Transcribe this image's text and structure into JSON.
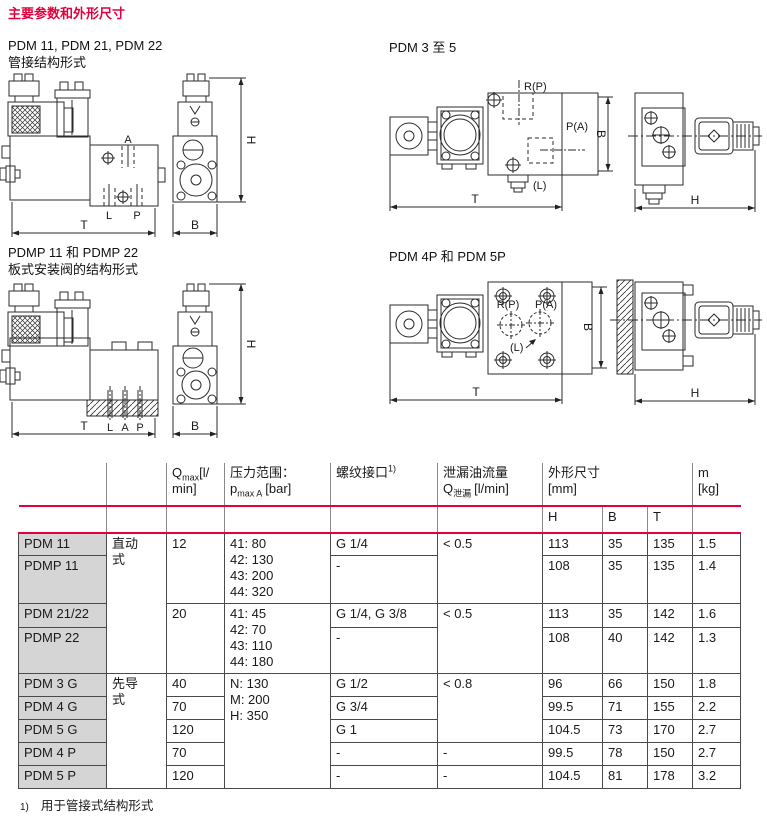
{
  "page": {
    "title": "主要参数和外形尺寸",
    "footnote_marker": "1)",
    "footnote_text": "用于管接式结构形式"
  },
  "figures": {
    "fig1": {
      "caption1": "PDM 11, PDM 21, PDM 22",
      "caption2": "管接结构形式",
      "labels": {
        "A": "A",
        "L": "L",
        "P": "P",
        "T": "T",
        "B": "B",
        "H": "H"
      }
    },
    "fig2": {
      "caption1": "PDM 3 至 5",
      "labels": {
        "RP": "R(P)",
        "PA": "P(A)",
        "L": "(L)",
        "T": "T",
        "B": "B",
        "H": "H"
      }
    },
    "fig3": {
      "caption1": "PDMP 11 和 PDMP 22",
      "caption2": "板式安装阀的结构形式",
      "labels": {
        "L": "L",
        "A": "A",
        "P": "P",
        "T": "T",
        "B": "B",
        "H": "H"
      }
    },
    "fig4": {
      "caption1": "PDM 4P 和 PDM 5P",
      "labels": {
        "RP": "R(P)",
        "PA": "P(A)",
        "L": "(L)",
        "T": "T",
        "B": "B",
        "H": "H"
      }
    }
  },
  "table": {
    "header": {
      "qmax_q": "Q",
      "qmax_sub": "max",
      "qmax_unit1": "[l/",
      "qmax_unit2": "min]",
      "pressure_title": "压力范围：",
      "pressure_p": "p",
      "pressure_sub": "max A",
      "pressure_unit": "[bar]",
      "thread_title": "螺纹接口",
      "thread_sup": "1)",
      "leak_title": "泄漏油流量",
      "leak_q": "Q",
      "leak_sub": "泄漏",
      "leak_unit": "[l/min]",
      "dims_title": "外形尺寸",
      "dims_unit": "[mm]",
      "dim_h": "H",
      "dim_b": "B",
      "dim_t": "T",
      "mass_title": "m",
      "mass_unit": "[kg]"
    },
    "rows": [
      {
        "model": "PDM 11",
        "type": "直动式",
        "qmax": "12",
        "pressure": "41: 80\n42: 130\n43: 200\n44: 320",
        "thread": "G 1/4",
        "leak": "< 0.5",
        "H": "113",
        "B": "35",
        "T": "135",
        "m": "1.5"
      },
      {
        "model": "PDMP 11",
        "thread": "-",
        "H": "108",
        "B": "35",
        "T": "135",
        "m": "1.4"
      },
      {
        "model": "PDM 21/22",
        "qmax": "20",
        "pressure": "41: 45\n42: 70\n43: 110\n44: 180",
        "thread": "G 1/4, G 3/8",
        "leak": "< 0.5",
        "H": "113",
        "B": "35",
        "T": "142",
        "m": "1.6"
      },
      {
        "model": "PDMP 22",
        "thread": "-",
        "H": "108",
        "B": "40",
        "T": "142",
        "m": "1.3"
      },
      {
        "model": "PDM 3 G",
        "type": "先导式",
        "qmax": "40",
        "pressure": "N: 130\nM: 200\nH: 350",
        "thread": "G 1/2",
        "leak": "< 0.8",
        "H": "96",
        "B": "66",
        "T": "150",
        "m": "1.8"
      },
      {
        "model": "PDM 4 G",
        "qmax": "70",
        "thread": "G 3/4",
        "H": "99.5",
        "B": "71",
        "T": "155",
        "m": "2.2"
      },
      {
        "model": "PDM 5 G",
        "qmax": "120",
        "thread": "G 1",
        "H": "104.5",
        "B": "73",
        "T": "170",
        "m": "2.7"
      },
      {
        "model": "PDM 4 P",
        "qmax": "70",
        "thread": "-",
        "leak": "-",
        "H": "99.5",
        "B": "78",
        "T": "150",
        "m": "2.7"
      },
      {
        "model": "PDM 5 P",
        "qmax": "120",
        "thread": "-",
        "leak": "-",
        "H": "104.5",
        "B": "81",
        "T": "178",
        "m": "3.2"
      }
    ]
  },
  "colors": {
    "accent_red": "#e4003c",
    "row_shade": "#d5d5d5"
  }
}
